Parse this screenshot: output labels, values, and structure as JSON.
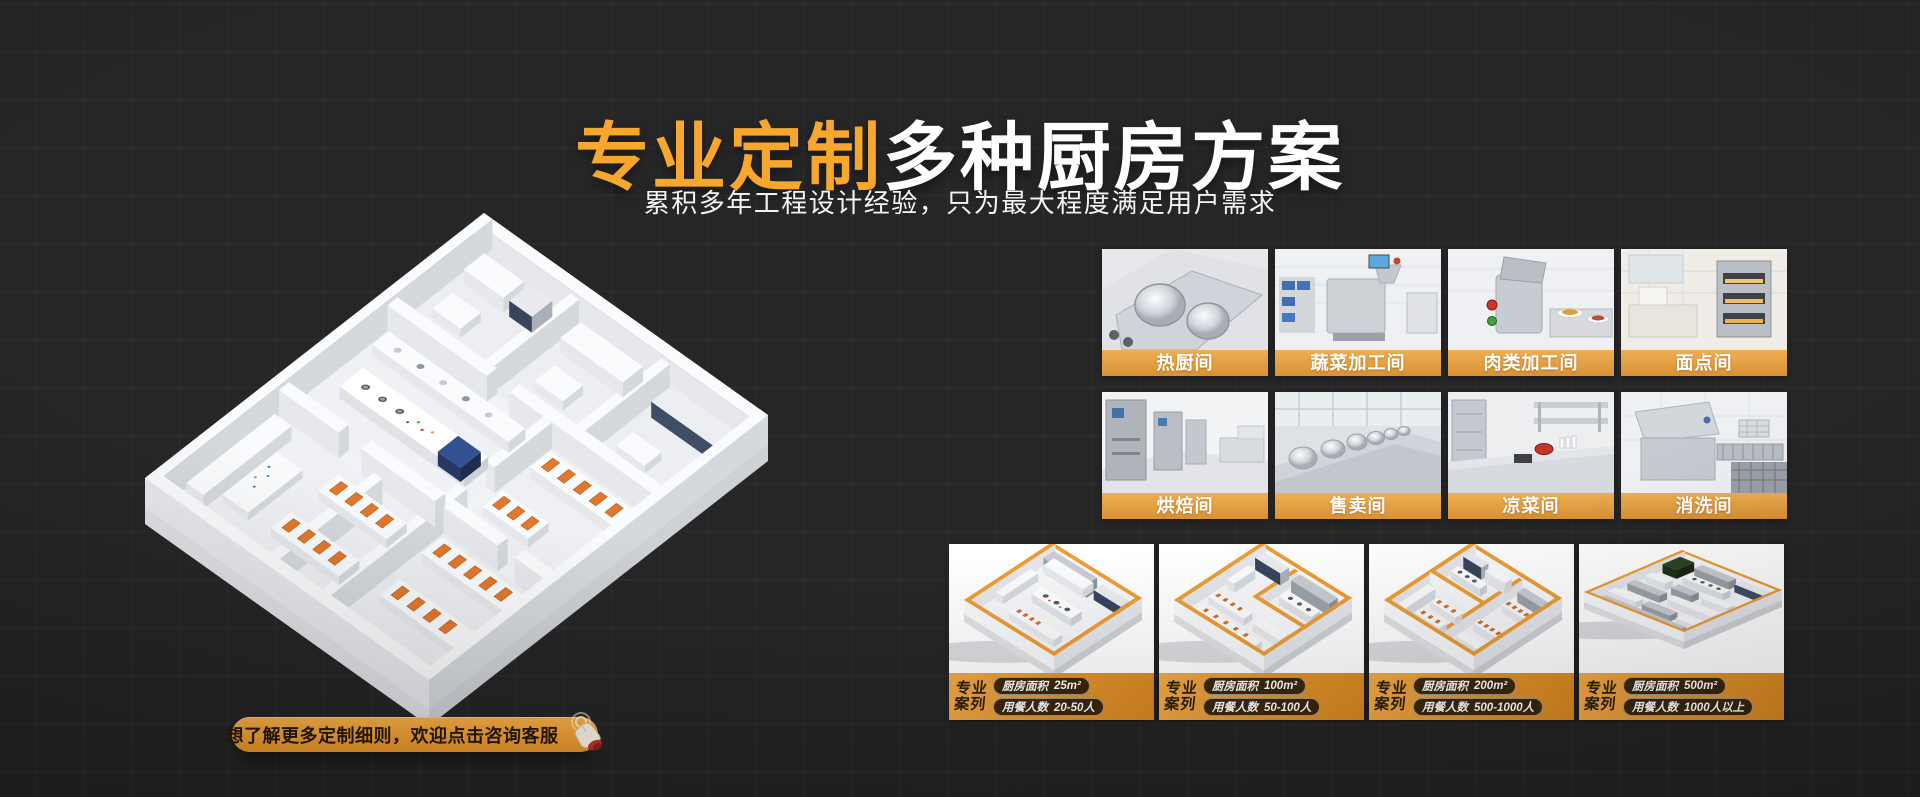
{
  "header": {
    "title_highlight": "专业定制",
    "title_rest": "多种厨房方案",
    "subtitle": "累积多年工程设计经验，只为最大程度满足用户需求"
  },
  "rooms": [
    {
      "label": "热厨间"
    },
    {
      "label": "蔬菜加工间"
    },
    {
      "label": "肉类加工间"
    },
    {
      "label": "面点间"
    },
    {
      "label": "烘焙间"
    },
    {
      "label": "售卖间"
    },
    {
      "label": "凉菜间"
    },
    {
      "label": "消洗间"
    }
  ],
  "cases": [
    {
      "tag_line1": "专业",
      "tag_line2": "案列",
      "specs": [
        {
          "label": "厨房面积",
          "value": "25m²"
        },
        {
          "label": "用餐人数",
          "value": "20-50人"
        }
      ]
    },
    {
      "tag_line1": "专业",
      "tag_line2": "案列",
      "specs": [
        {
          "label": "厨房面积",
          "value": "100m²"
        },
        {
          "label": "用餐人数",
          "value": "50-100人"
        }
      ]
    },
    {
      "tag_line1": "专业",
      "tag_line2": "案列",
      "specs": [
        {
          "label": "厨房面积",
          "value": "200m²"
        },
        {
          "label": "用餐人数",
          "value": "500-1000人"
        }
      ]
    },
    {
      "tag_line1": "专业",
      "tag_line2": "案列",
      "specs": [
        {
          "label": "厨房面积",
          "value": "500m²"
        },
        {
          "label": "用餐人数",
          "value": "1000人以上"
        }
      ]
    }
  ],
  "cta": {
    "label": "想了解更多定制细则，欢迎点击咨询客服"
  },
  "colors": {
    "background": "#232323",
    "accent_orange": "#F7A52B",
    "label_bar_top": "#F0AA48",
    "label_bar_bottom": "#D78B26",
    "case_bar": "#E3922A",
    "cta_top": "#F9B045",
    "cta_bottom": "#EC9526"
  }
}
